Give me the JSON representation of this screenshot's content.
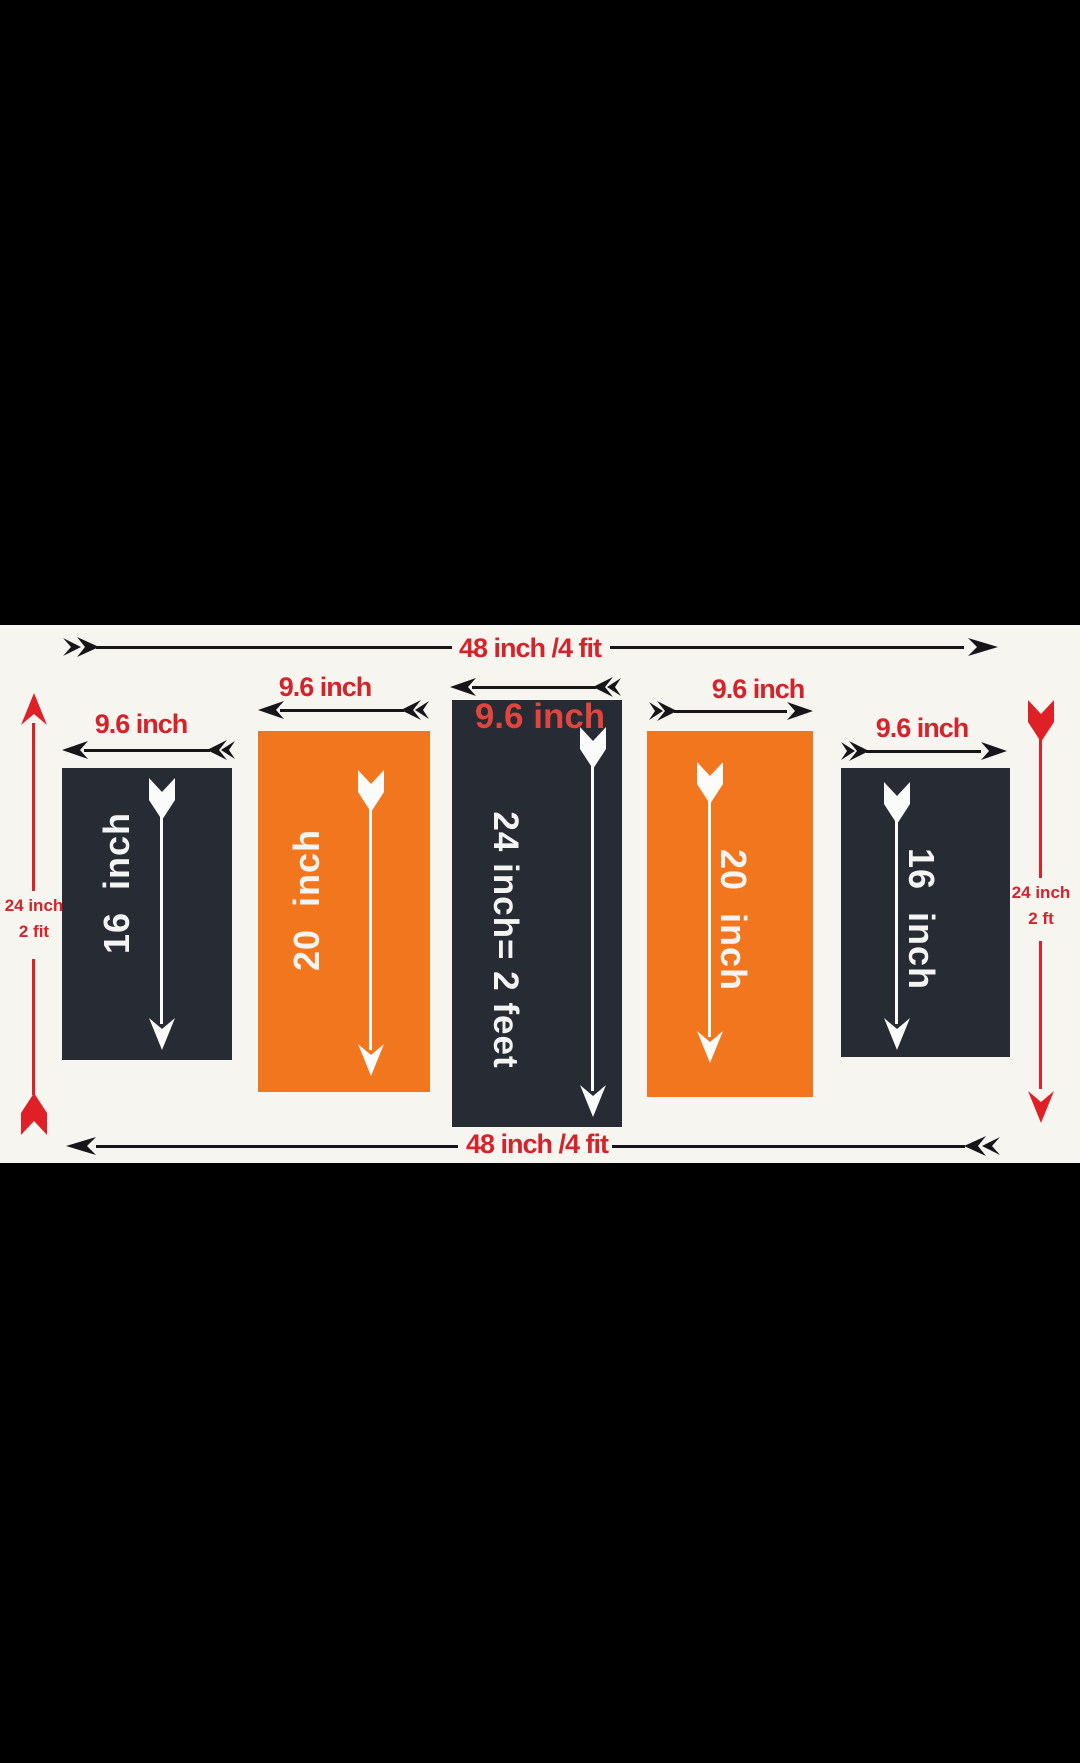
{
  "colors": {
    "dark_panel": "#262b34",
    "orange_panel": "#f2761e",
    "red_label": "#d4232b",
    "overlay_red": "#e2453c",
    "arrow_black": "#16161a",
    "arrow_white": "#fbfbf9",
    "arrow_red": "#df2127",
    "background_band": "#f7f5f0",
    "letterbox": "#000000"
  },
  "dimensions": {
    "top": "48 inch /4 fit",
    "bottom": "48 inch /4 fit",
    "left": {
      "line1": "24 inch",
      "line2": "2 fit"
    },
    "right": {
      "line1": "24 inch",
      "line2": "2 ft"
    }
  },
  "panels": [
    {
      "width_label": "9.6 inch",
      "size_label": "16  inch",
      "color_name": "dark"
    },
    {
      "width_label": "9.6 inch",
      "size_label": "20  inch",
      "color_name": "orange"
    },
    {
      "width_label": "9.6 inch",
      "size_label": "24 inch= 2 feet",
      "color_name": "dark"
    },
    {
      "width_label": "9.6 inch",
      "size_label": "20  inch",
      "color_name": "orange"
    },
    {
      "width_label": "9.6 inch",
      "size_label": "16  inch",
      "color_name": "dark"
    }
  ]
}
